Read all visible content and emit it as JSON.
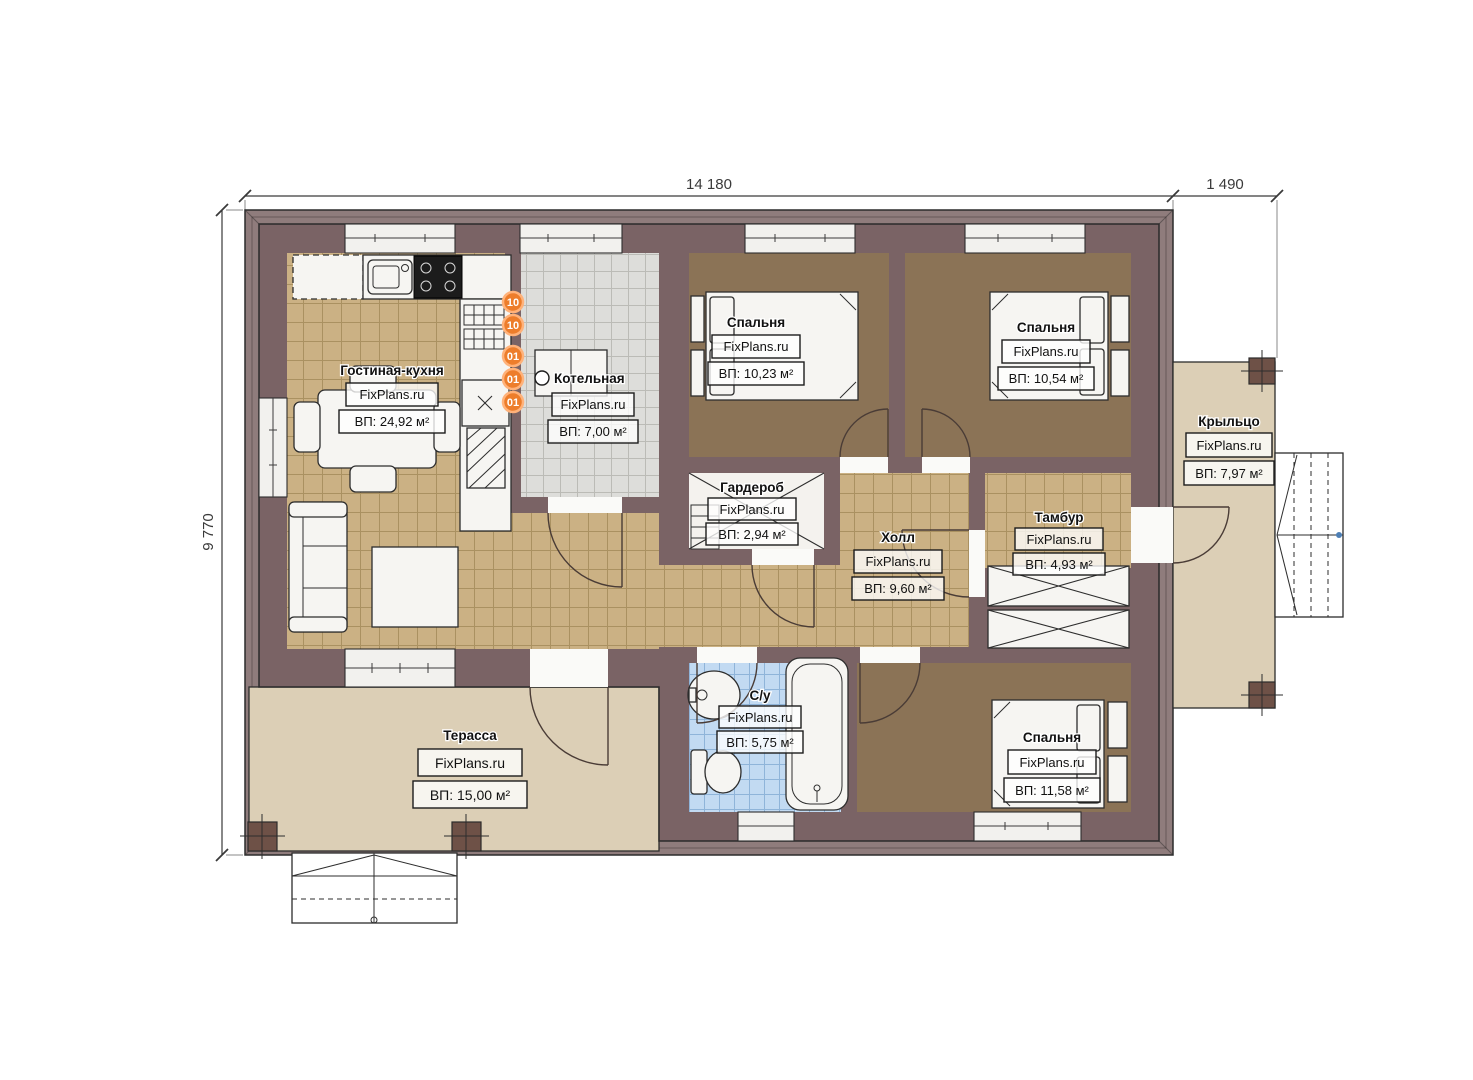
{
  "plan": {
    "dimensions": {
      "width_main": "14 180",
      "width_porch": "1 490",
      "height": "9 770"
    },
    "brand": "FixPlans.ru",
    "rooms": [
      {
        "id": "living-kitchen",
        "name": "Гостиная-кухня",
        "area": "ВП: 24,92 м²"
      },
      {
        "id": "boiler",
        "name": "Котельная",
        "area": "ВП: 7,00 м²"
      },
      {
        "id": "bedroom-1",
        "name": "Спальня",
        "area": "ВП: 10,23 м²"
      },
      {
        "id": "bedroom-2",
        "name": "Спальня",
        "area": "ВП: 10,54 м²"
      },
      {
        "id": "wardrobe",
        "name": "Гардероб",
        "area": "ВП: 2,94 м²"
      },
      {
        "id": "hall",
        "name": "Холл",
        "area": "ВП: 9,60 м²"
      },
      {
        "id": "vestibule",
        "name": "Тамбур",
        "area": "ВП: 4,93 м²"
      },
      {
        "id": "porch",
        "name": "Крыльцо",
        "area": "ВП: 7,97 м²"
      },
      {
        "id": "bathroom",
        "name": "С/у",
        "area": "ВП: 5,75 м²"
      },
      {
        "id": "bedroom-3",
        "name": "Спальня",
        "area": "ВП: 11,58 м²"
      },
      {
        "id": "terrace",
        "name": "Терасса",
        "area": "ВП: 15,00 м²"
      }
    ],
    "markers": [
      "10",
      "10",
      "01",
      "01",
      "01"
    ],
    "colors": {
      "wall": "#7A6365",
      "roof_band": "#8F7C7C",
      "floor_tile": "#CBB184",
      "bedroom_floor": "#8B7356",
      "boiler_floor": "#DDDDDA",
      "bath_floor": "#C2DAF2",
      "terrace_floor": "#DCCFB6",
      "marker": "#ED7D2B"
    }
  }
}
